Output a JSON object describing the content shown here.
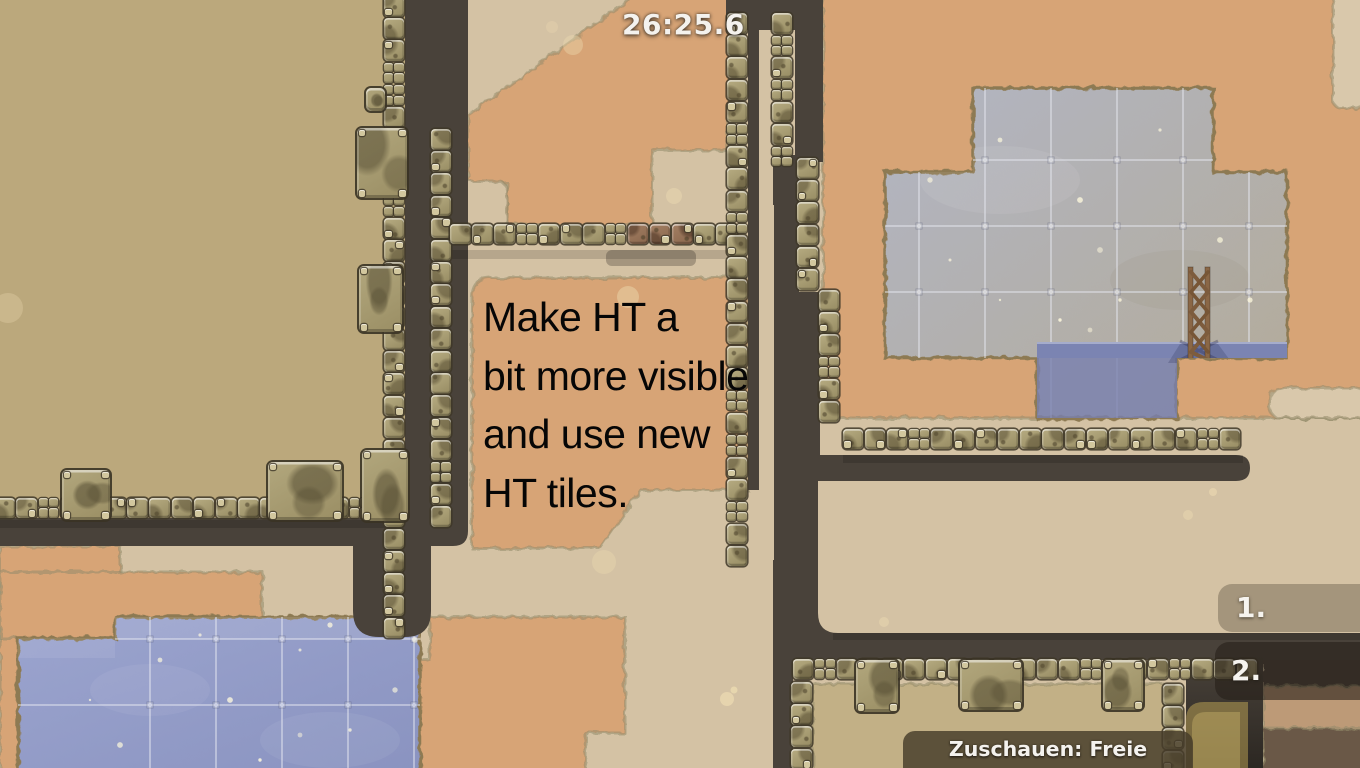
{
  "hud": {
    "timer": "26:25.6",
    "spectate_label": "Zuschauen: Freie Ansicht",
    "rank_badges": [
      {
        "label": "1."
      },
      {
        "label": "2."
      }
    ]
  },
  "annotation": {
    "lines": [
      "Make HT a",
      "bit more visible",
      "and use new",
      "HT tiles."
    ]
  },
  "scene": {
    "description": "2D tile-based race map viewed in spectator free-camera mode",
    "icons": [
      "wooden-truss-tower"
    ],
    "palette": {
      "ground_khaki": "#bba87c",
      "ground_sand": "#d4c2a4",
      "ground_clay": "#d7a476",
      "tunnel_dark": "#49423a",
      "tile_face": "#a89d73",
      "tile_rust": "#97755c",
      "glass_blue": "#95a0ca",
      "glass_gray": "#b1b0ab",
      "water_blue": "#7b84b2",
      "hud_text": "#f4f2ee"
    }
  }
}
